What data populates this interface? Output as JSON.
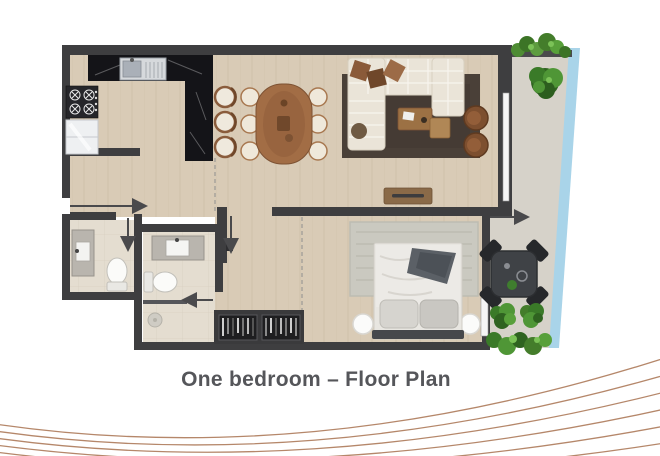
{
  "caption": {
    "text": "One bedroom – Floor Plan"
  },
  "palette": {
    "wall": "#3e3e40",
    "wood_floor": "#d9cbb6",
    "tile_floor": "#e4ddd0",
    "balcony_floor": "#d6d2c9",
    "glass_balustrade": "#a9d4e9",
    "counter_marble": "#141418",
    "living_rug": "#4a4038",
    "bedroom_rug": "#cac9c0",
    "sofa": "#eae4d8",
    "wood_furniture": "#a26d45",
    "plant_green": "#447d2b",
    "decor_line": "#b5876a",
    "caption_text": "#55565a"
  },
  "decor": {
    "curve_count": 6
  }
}
